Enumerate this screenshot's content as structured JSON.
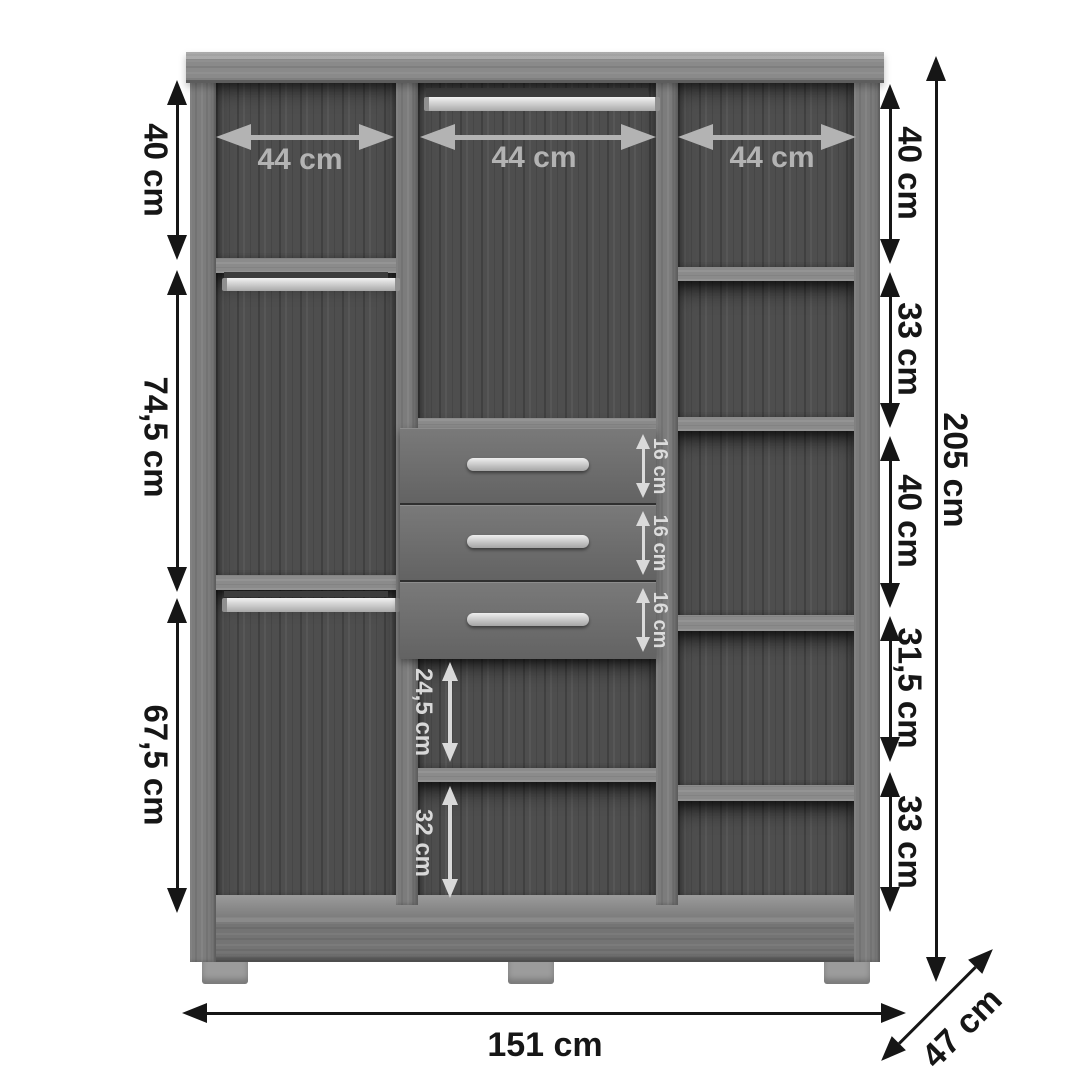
{
  "diagram": {
    "type": "furniture-dimension-diagram",
    "subject": "wardrobe interior front view with shelves, hanging rods and drawers",
    "units": "cm"
  },
  "dims": {
    "top_widths": [
      "44 cm",
      "44 cm",
      "44 cm"
    ],
    "left_heights": [
      "40 cm",
      "74,5 cm",
      "67,5 cm"
    ],
    "right_heights": [
      "40 cm",
      "33 cm",
      "40 cm",
      "31,5 cm",
      "33 cm"
    ],
    "drawer_heights": [
      "16 cm",
      "16 cm",
      "16 cm"
    ],
    "middle_lower_heights": [
      "24,5 cm",
      "32 cm"
    ],
    "total_height": "205 cm",
    "total_width": "151 cm",
    "depth": "47 cm"
  },
  "colors": {
    "background": "#ffffff",
    "annotation_outer": "#161616",
    "annotation_inner": "#dadada",
    "annotation_top": "#b3b3b3",
    "wood_light": "#7c7c7c",
    "wood_dark": "#4e4e4e"
  }
}
